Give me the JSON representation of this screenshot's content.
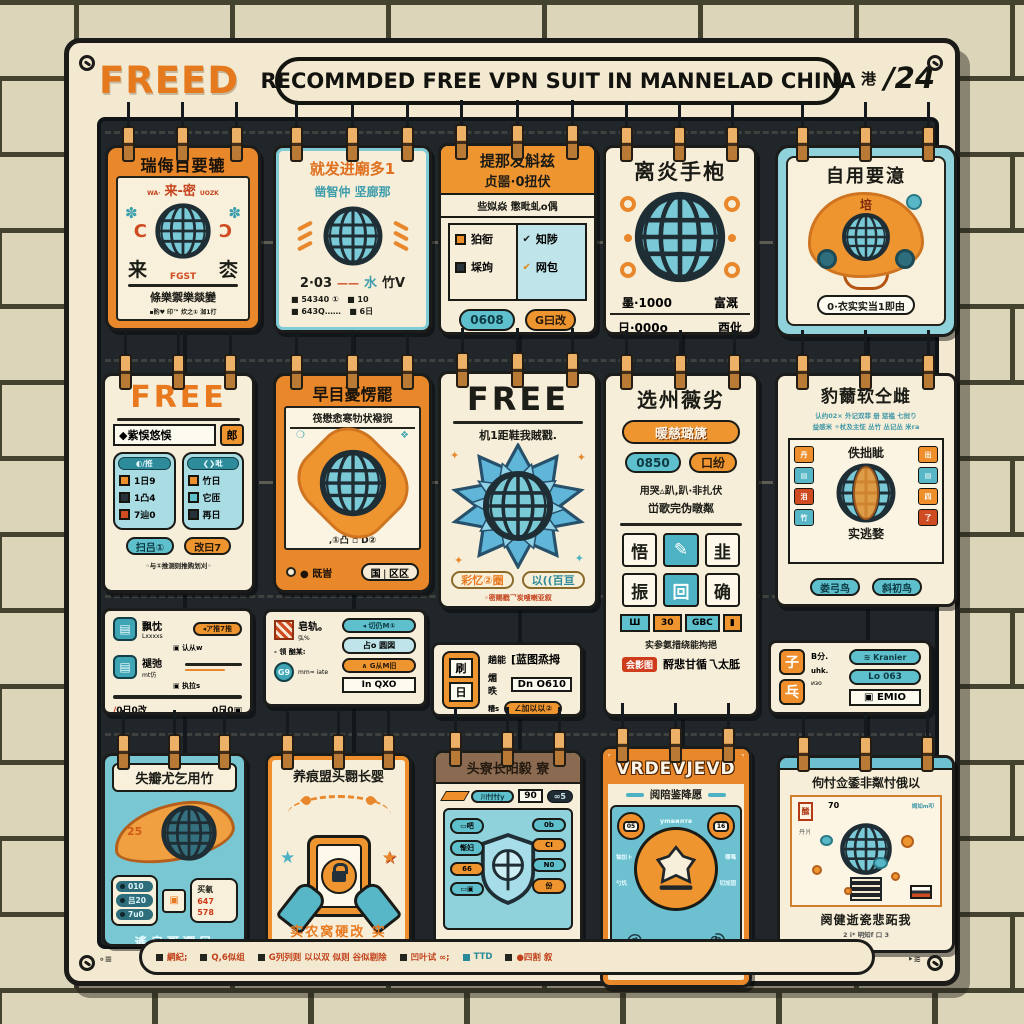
{
  "header": {
    "logo": "FREED",
    "banner": "RECOMMDED FREE VPN SUIT IN MANNELAD CHINA",
    "stamp_glyph": "港",
    "stamp_number": "∕24"
  },
  "palette": {
    "orange": "#E8892B",
    "teal": "#69C3CF",
    "red": "#C94A1E",
    "cream": "#F4EBD3",
    "board_dark": "#20262A"
  },
  "cards": {
    "r1c1": {
      "header": "瑞侮目要辘",
      "tag_left": "WA·",
      "subtitle": "来-密",
      "tag_right": "UOZK",
      "knot": "✽",
      "bracket_left": "C",
      "bracket_right": "Ɔ",
      "char_left": "来",
      "globe_label": "FGST",
      "char_right": "枩",
      "row": "條樂禦樂燚變",
      "footer": "▪酌♥ 印™ 炊之① 洳1打"
    },
    "r1c2": {
      "title": "就发进廟多1",
      "subtitle": "凿智仲 坚廊那",
      "mid1": "2·03",
      "mid2": "——",
      "mid3": "水",
      "mid4": "竹V",
      "line1": "■ 54340 ①   ■ 10",
      "line2": "■ 643Q……   ■ 6日"
    },
    "r1c3": {
      "h1": "提那发斛兹",
      "h2": "贞噐·0扭伏",
      "strip": "些姒焱 懲毗虬о偶",
      "l1": "狛衐",
      "l2": "埰竘",
      "check1": "✔",
      "r1": "知陟",
      "check2": "✔",
      "r2": "网包",
      "pill1": "0608",
      "pill2": "G曰改"
    },
    "r1c4": {
      "title": "离炎手枹",
      "s1l": "墨·1000",
      "s1r": "富溉",
      "s2l": "日·000о",
      "s2r": "酉仳"
    },
    "r1c5": {
      "title": "自用要澺",
      "badge": "培",
      "pill": "0·衣实实当1即由"
    },
    "r2c1": {
      "free": "FREE",
      "box": "◆紫悞悠悞",
      "badge": "郎",
      "pa_head": "◐∕拰",
      "pa0": "1日9",
      "pa1": "1凸4",
      "pa2": "7辿0",
      "pb_head": "❮❯吡",
      "pb0": "竹日",
      "pb1": "它匝",
      "pb2": "再日",
      "pill1": "扫吕①",
      "pill2": "改曰7",
      "footer": "◦与①推测则推购划刈◦"
    },
    "r2c2": {
      "header": "早目憂愣罷",
      "strip": "筏懋悆寒牞状襏猊",
      "glyph_l": "❍",
      "glyph_r": "❖",
      "dots": "‚①凸 ▫ D②",
      "foot_left": "● 既旹",
      "pill": "国❘区区"
    },
    "r2c3": {
      "free": "FREE",
      "line": "机1距鞋我賊戳.",
      "sparkle": "✦",
      "pill1": "彩忆②圈",
      "pill2": "以((百亘",
      "footer": "◦密赐戳乛炭嗖喇亚叙"
    },
    "r2c4": {
      "title": "选州薇劣",
      "top_pill": "暖慈璐篪",
      "pill1": "0850",
      "pill2": "口纷",
      "l1": "用哭▵趴,趴·非扎伏",
      "l2": "峃歌完伪暾粼",
      "t1": "悟",
      "t2": "✎",
      "t3": "韭",
      "t4": "振",
      "t5": "回",
      "t6": "确",
      "s1": "Ш",
      "s2": "30",
      "s3": "GBC",
      "s4": "▮",
      "l3": "实参氨措绕能拘挹",
      "badge": "会影图",
      "l4": "酹悲甘循乁太胝"
    },
    "r2c5": {
      "title": "豹薾软仝雌",
      "tiny1": "认约02× 外记双菲 册 惩褴 七挝り",
      "tiny2": "益感米 ÷杖及主怔 丛竹 丛记丛 米га",
      "p_top": "佚拙眦",
      "p_bot": "实逃婺",
      "cl0": "丹",
      "cl1": "▤",
      "cl2": "泪",
      "cl3": "竹",
      "cr0": "出",
      "cr1": "▤",
      "cr2": "四",
      "cr3": "了",
      "pill1": "娄弓鸟",
      "pill2": "斜初鸟"
    },
    "m1": {
      "icon": "▤",
      "r1": "飘忱",
      "r1s": "Lxxxxs",
      "badge1": "◂ア推7推",
      "r1b": "▣ 认从w",
      "r2": "褪弛",
      "r2s": "mt仿",
      "r2b": "▣ 执拉s",
      "fl1": "∕",
      "fl2": "0日0改",
      "fr": "0日0▣"
    },
    "m2": {
      "stamp": "燚",
      "t1": "皂轨。",
      "t2": "弘%",
      "pill1": "◂ 切仍M①",
      "box": "占о 圆図",
      "t3": "- 领 酗某:",
      "pill2": "∧ G从M旧",
      "circ": "G9",
      "t4": "mm≈ iate",
      "pill3": "In QXO"
    },
    "m3": {
      "i1": "刷",
      "i2": "日",
      "r1a": "趟能",
      "r1b": "[蓝图烝拇",
      "r2a": "煝昳",
      "box": "Dn O610",
      "r3a": "糟s",
      "pill": "∠加以以②"
    },
    "m4": {
      "i1": "子",
      "i2": "乓",
      "t1": "B分.",
      "t2": "uhk.",
      "t3": "изо",
      "pill1": "≋ Kranier",
      "pill2": "Lо 063",
      "pill3": "▣ EMIO"
    },
    "r3c1": {
      "title": "失瓣尤乞用竹",
      "badge": "25",
      "pl0": "010",
      "pl1": "吕20",
      "pl2": "7u0",
      "mini": "▣",
      "pr0": "买氡",
      "pr1": "647",
      "pr2": "578",
      "footer": "遙皂哥選尼"
    },
    "r3c2": {
      "title": "养痕盟头翾长婴",
      "star_l": "★",
      "star_r": "★",
      "footer": "实农窝硬改 实"
    },
    "r3c3": {
      "header": "头寮长阳毅 寮",
      "top_pill": "川忖忖y",
      "box": "90",
      "dark_pill": "∞5",
      "ll0": "▭吧",
      "ll1": "惭妇",
      "ll2": "66",
      "ll3": "▭▣",
      "rr0": "0b",
      "rr1": "CI",
      "rr2": "N0",
      "rr3": "份",
      "footer": "吕扔卜 ·闾卧甜"
    },
    "r3c4": {
      "header": "VRDEVJEVD",
      "strip": "阅陪鉴降愿",
      "circ_l": "05",
      "circ_r": "16",
      "tiny": "уmвилтв",
      "sl0": "铀加卜",
      "sl1": "勺饥",
      "sr0": "哪嗎",
      "sr1": "切加固",
      "swirl": "@",
      "footer": "自战暑岂首龋"
    },
    "r3c5": {
      "title": "佝忖佥鋈非粼忖俄以",
      "t70": "70",
      "ttl": "丹爿",
      "ttr": "姆如m叩",
      "stamp": "䤉",
      "footer1": "阕健逝瓷悲跖我",
      "footer2": "2 i* 明知f 口 3"
    }
  },
  "footer_bar": {
    "left_mark": "∘≡",
    "items": [
      "網紀;",
      "Q,6似组",
      "G列列则 以以双 似则 谷似剔除",
      "凹叶试 ∞;",
      "TTD",
      "●四割 叙"
    ],
    "right_mark": "‣≋"
  }
}
